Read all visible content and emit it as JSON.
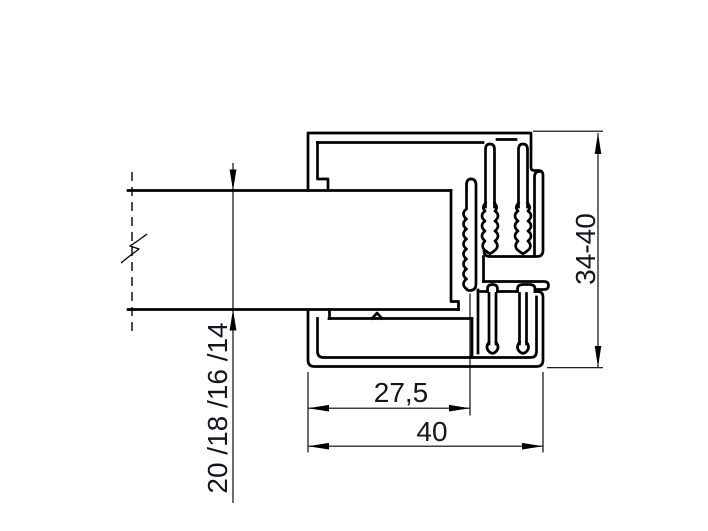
{
  "drawing": {
    "type": "technical-cross-section",
    "background_color": "#ffffff",
    "line_color": "#000000",
    "dimension_text_color": "#15161d",
    "dimensions": {
      "glass_thickness": {
        "label": "20 /18 /16 /14",
        "orientation": "vertical-rotated"
      },
      "inner_width": {
        "label": "27,5",
        "orientation": "horizontal"
      },
      "outer_width": {
        "label": "40",
        "orientation": "horizontal"
      },
      "height_range": {
        "label": "34-40",
        "orientation": "vertical-rotated"
      }
    }
  }
}
